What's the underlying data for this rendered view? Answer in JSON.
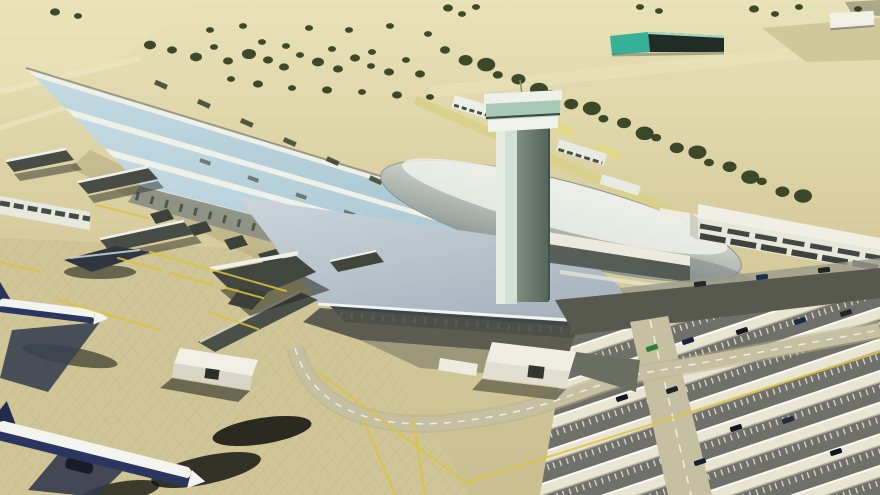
{
  "scene": {
    "title": "Aerial architectural rendering of an airport terminal complex",
    "type": "3d-render",
    "description": "Long terminal building with barrel-vault skylight roof and large silver lens-shaped roof element, control tower, tree-lined landside road, teal warehouse, parked airliners with jet bridges on the apron, parking lots with canopies, curved access roads"
  },
  "colors": {
    "ground": "#d7cd9e",
    "ground_light": "#e9e2b8",
    "ground_dark": "#c9bf90",
    "apron": "#cfc596",
    "vault_blue": "#aac8d4",
    "vault_blue_light": "#c4dae2",
    "roof_white": "#eef0ea",
    "lens_top": "#e2e6e0",
    "lens_bottom": "#8e9893",
    "slab_top": "#ccd5da",
    "slab_bottom": "#a7b4be",
    "facade_dark": "#3f464b",
    "colonnade": "#8b9086",
    "tower_light": "#e4ece2",
    "tower_glass": "#cfe0d4",
    "tower_dark": "#66786a",
    "teal_building": "#35b199",
    "tree": "#2e3d1d",
    "road_dark": "#57594f",
    "road_light": "#c6c0a2",
    "parking_lane": "#70706a",
    "canopy": "#e9e5d3",
    "line_yellow": "#dfc33b",
    "line_white": "#f2f1e8",
    "plane_white": "#f3f3ef",
    "plane_navy": "#2a3560",
    "shadow": "#1b1c17",
    "building_white": "#f0efe6",
    "window_dark": "#303832"
  },
  "decor": {
    "tree_line": {
      "x1": 448,
      "y1": 50,
      "x2": 800,
      "y2": 196,
      "count": 21
    },
    "tree_scatter": [
      [
        55,
        12,
        5
      ],
      [
        78,
        16,
        4
      ],
      [
        150,
        45,
        6
      ],
      [
        172,
        50,
        5
      ],
      [
        196,
        57,
        6
      ],
      [
        214,
        47,
        4
      ],
      [
        228,
        61,
        5
      ],
      [
        249,
        54,
        7
      ],
      [
        268,
        60,
        5
      ],
      [
        284,
        67,
        5
      ],
      [
        300,
        55,
        4
      ],
      [
        318,
        62,
        6
      ],
      [
        338,
        69,
        5
      ],
      [
        355,
        58,
        5
      ],
      [
        371,
        66,
        4
      ],
      [
        389,
        72,
        5
      ],
      [
        406,
        60,
        4
      ],
      [
        420,
        74,
        5
      ],
      [
        231,
        79,
        4
      ],
      [
        258,
        84,
        5
      ],
      [
        292,
        88,
        4
      ],
      [
        327,
        90,
        5
      ],
      [
        362,
        92,
        4
      ],
      [
        397,
        95,
        5
      ],
      [
        430,
        97,
        4
      ],
      [
        210,
        30,
        4
      ],
      [
        243,
        26,
        4
      ],
      [
        309,
        28,
        4
      ],
      [
        349,
        30,
        4
      ],
      [
        390,
        26,
        4
      ],
      [
        428,
        34,
        4
      ],
      [
        448,
        8,
        5
      ],
      [
        462,
        14,
        4
      ],
      [
        476,
        7,
        4
      ],
      [
        640,
        7,
        4
      ],
      [
        659,
        11,
        4
      ],
      [
        754,
        9,
        5
      ],
      [
        775,
        14,
        4
      ],
      [
        799,
        7,
        4
      ],
      [
        858,
        9,
        4
      ],
      [
        262,
        42,
        4
      ],
      [
        286,
        46,
        4
      ],
      [
        332,
        49,
        4
      ],
      [
        372,
        52,
        4
      ]
    ],
    "cars": [
      [
        700,
        284,
        -7,
        "#23262b"
      ],
      [
        762,
        277,
        -7,
        "#1c2f52"
      ],
      [
        824,
        270,
        -7,
        "#20241f"
      ],
      [
        652,
        348,
        -18,
        "#2e7d3a"
      ],
      [
        688,
        341,
        -18,
        "#1a2440"
      ],
      [
        742,
        331,
        -18,
        "#15181e"
      ],
      [
        800,
        321,
        -18,
        "#1b2a4c"
      ],
      [
        846,
        313,
        -18,
        "#22262a"
      ],
      [
        622,
        398,
        -18,
        "#101826"
      ],
      [
        672,
        390,
        -18,
        "#1d222c"
      ],
      [
        736,
        428,
        -18,
        "#0f1522"
      ],
      [
        788,
        420,
        -18,
        "#242c38"
      ],
      [
        836,
        452,
        -18,
        "#10141e"
      ],
      [
        700,
        462,
        -18,
        "#1a2030"
      ],
      [
        618,
        368,
        -18,
        "#caa92f"
      ]
    ],
    "yellow_lines": [
      [
        150,
        252,
        286,
        291
      ],
      [
        58,
        300,
        160,
        330
      ],
      [
        0,
        262,
        40,
        272
      ],
      [
        118,
        258,
        160,
        270
      ],
      [
        170,
        273,
        213,
        285
      ],
      [
        223,
        287,
        263,
        298
      ],
      [
        208,
        312,
        258,
        329
      ],
      [
        318,
        372,
        466,
        483
      ],
      [
        466,
        483,
        880,
        352
      ],
      [
        363,
        418,
        396,
        497
      ],
      [
        413,
        418,
        425,
        497
      ],
      [
        96,
        205,
        148,
        218
      ]
    ]
  }
}
